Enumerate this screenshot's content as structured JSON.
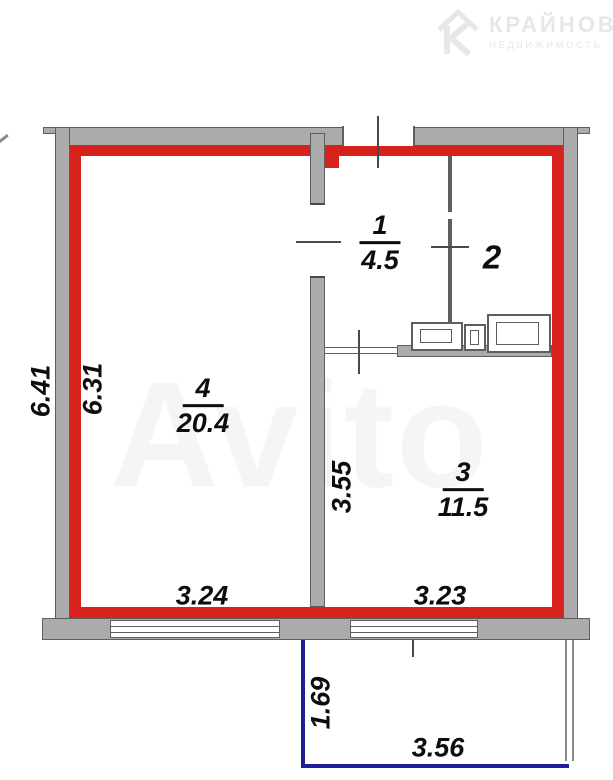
{
  "branding": {
    "logo_letter": "К",
    "logo_title": "КРАЙНОВ",
    "logo_subtitle": "НЕДВИЖИМОСТЬ",
    "watermark": "Avito"
  },
  "colors": {
    "outline_red": "#d7211d",
    "balcony_blue": "#1e1e9e",
    "wall_gray": "#ababab",
    "wall_edge": "#5e5e5e",
    "tick_gray": "#4a4a4a",
    "label_color": "#0d0d0d",
    "logo_gray": "#e7e7e7"
  },
  "rooms": {
    "room1": {
      "number": "1",
      "area": "4.5"
    },
    "room2": {
      "number": "2"
    },
    "room3": {
      "number": "3",
      "area": "11.5"
    },
    "room4": {
      "number": "4",
      "area": "20.4"
    }
  },
  "dimensions": {
    "left_outer": "6.41",
    "left_inner": "6.31",
    "room4_width": "3.24",
    "room3_width": "3.23",
    "hall_height": "3.55",
    "balcony_depth": "1.69",
    "balcony_width": "3.56"
  }
}
